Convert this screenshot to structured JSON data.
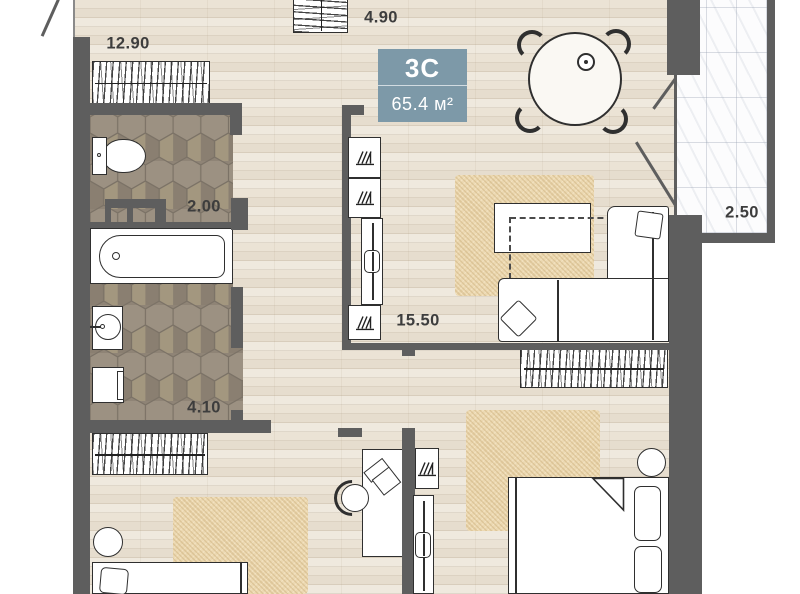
{
  "badge": {
    "plan_type": "3C",
    "area": "65.4 м²",
    "background_color": "#7d99a8"
  },
  "labels": {
    "top_left_room": "12.90",
    "hallway": "4.90",
    "wc": "2.00",
    "bathroom": "4.10",
    "living_room": "15.50",
    "balcony": "2.50"
  },
  "colors": {
    "wall": "#5e5e5e",
    "wood_floor": "#ebe3d5",
    "hex_tile": "#9a8f80",
    "rug": "#ecd9b2",
    "furniture_outline": "#2f2f2f",
    "balcony_tile": "#fcfcfd"
  }
}
